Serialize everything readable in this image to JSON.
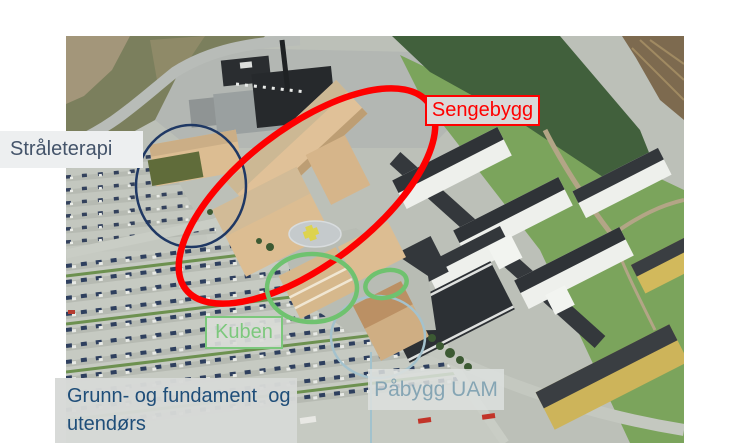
{
  "slide": {
    "labels": {
      "straleterapi": "Stråleterapi",
      "sengebygg": "Sengebygg",
      "kuben": "Kuben",
      "grunn_line1": "Grunn- og fundament  og",
      "grunn_line2": "utendørs",
      "pabygg_uam": "Påbygg UAM"
    },
    "annotations": {
      "red_ellipse": {
        "target": "Sengebygg",
        "color": "#FF0000"
      },
      "navy_ellipse": {
        "target": "Stråleterapi",
        "color": "#1F3864"
      },
      "green_ellipse_large": {
        "target": "Kuben",
        "color": "#6FC26F"
      },
      "green_ellipse_small": {
        "target": "Påbygg UAM roof",
        "color": "#6FC26F"
      },
      "steel_ellipse": {
        "target": "Påbygg UAM",
        "color": "#A4C2CD"
      }
    },
    "colors": {
      "label_text_dark_slate": "#44546A",
      "label_text_dark_blue": "#1F4E79",
      "label_text_green": "#7DC87D",
      "label_text_steel": "#85A5B4",
      "label_bg_gray": "#D9D9D9"
    }
  }
}
